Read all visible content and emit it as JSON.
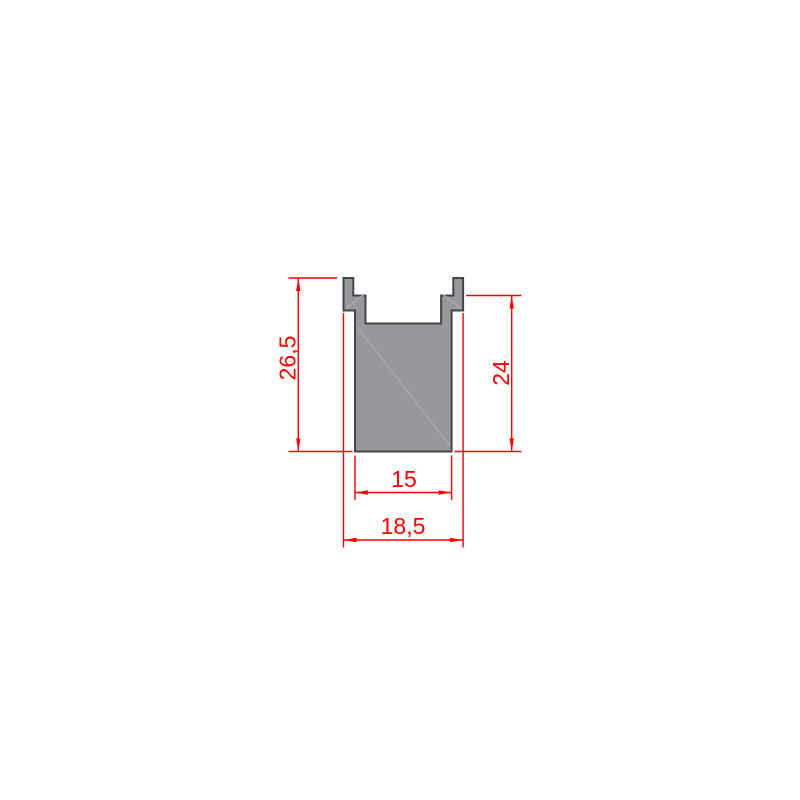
{
  "colors": {
    "background": "#ffffff",
    "dimension": "#ff0000",
    "profile_fill": "#96989b",
    "profile_outline": "#434548",
    "face_line": "#adafb2"
  },
  "drawing": {
    "type": "technical-profile-cross-section",
    "dimensions": [
      {
        "id": "overall-height",
        "label": "26,5",
        "orientation": "vertical",
        "side": "left"
      },
      {
        "id": "groove-height",
        "label": "24",
        "orientation": "vertical",
        "side": "right"
      },
      {
        "id": "base-width",
        "label": "15",
        "orientation": "horizontal",
        "side": "bottom"
      },
      {
        "id": "overall-width",
        "label": "18,5",
        "orientation": "horizontal",
        "side": "bottom"
      }
    ]
  }
}
